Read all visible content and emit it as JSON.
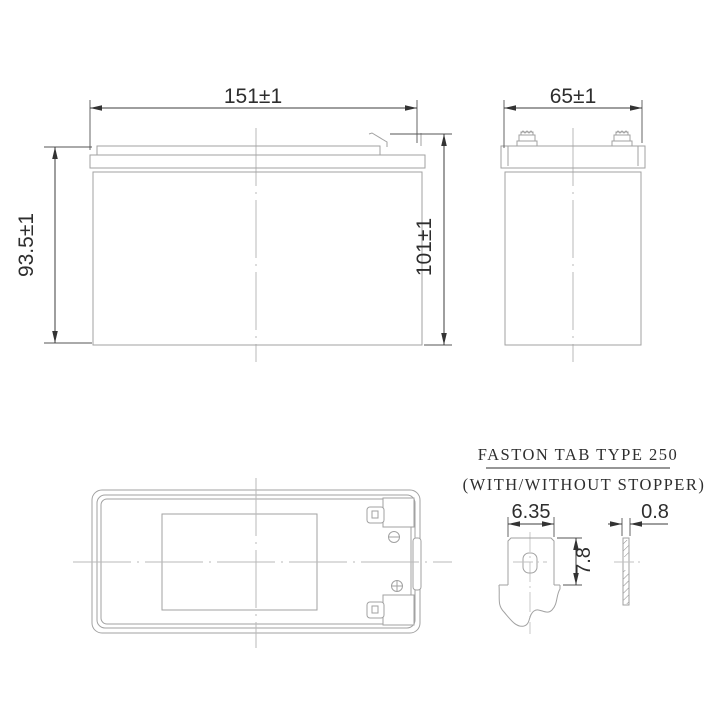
{
  "front_view": {
    "width_dim": "151±1",
    "case_height_dim": "93.5±1",
    "total_height_dim": "101±1"
  },
  "side_view": {
    "width_dim": "65±1"
  },
  "top_view": {
    "negative_mark_icon": "circle-minus",
    "positive_mark_icon": "circle-plus"
  },
  "tab_detail": {
    "title": "FASTON TAB TYPE 250",
    "subtitle": "(WITH/WITHOUT STOPPER)",
    "tab_width_dim": "6.35",
    "tab_height_dim": "7.8",
    "tab_thickness_dim": "0.8"
  },
  "colors": {
    "background": "#ffffff",
    "outline": "#a2a2a2",
    "dimension": "#3d3d3d",
    "text": "#2e2e2e"
  }
}
